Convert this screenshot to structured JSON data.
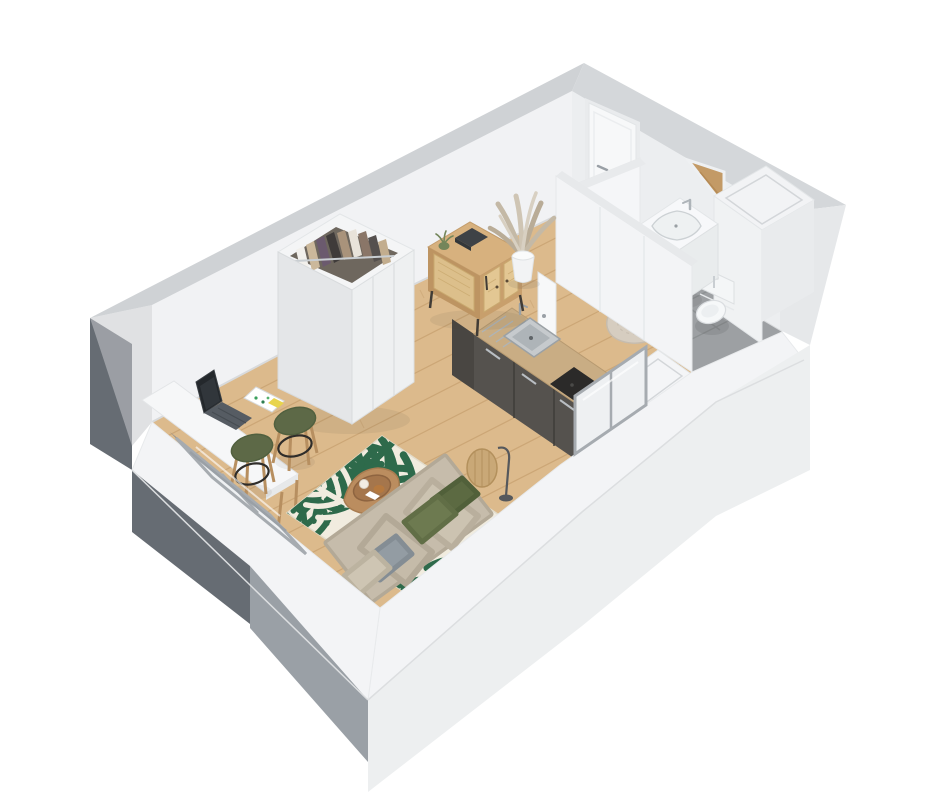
{
  "scene": {
    "description": "Isometric 3D cutaway floor plan render of a studio apartment, viewed from above",
    "background": "#ffffff"
  },
  "palette": {
    "background": "#ffffff",
    "wall_inner": "#f1f2f4",
    "wall_inner_shaded": "#eceef0",
    "wall_top_far": "#cfd2d5",
    "wall_band": "#f3f4f6",
    "exterior_dark": "#666c73",
    "exterior_medium": "#9aa0a6",
    "exterior_pale": "#edeff0",
    "wood_floor": "#dcba8c",
    "wood_line": "#b98f5c",
    "tile_floor": "#9da0a3",
    "tile_line": "#8a8d90",
    "rug_cream": "#f1ecdf",
    "rug_green": "#2e6a4b",
    "sofa_beige": "#c6bcab",
    "pillow_olive": "#6d7a50",
    "pillow_olive_dark": "#5c6a42",
    "pillow_gray": "#939ca3",
    "stool_green": "#5d6947",
    "sideboard_wood": "#d7b17e",
    "rattan_panel": "#e3c793",
    "kitchen_cabinet": "#55524e",
    "kitchen_counter": "#c9ad84",
    "steel": "#a6abb0",
    "door_white": "#f7f8f9",
    "bath_rug": "#d6cdc0",
    "mirror_wood": "#c39a66",
    "lamp_rattan": "#c9a877",
    "plant_beige": "#c4b9a6",
    "plant_green": "#6f8153"
  },
  "apartment": {
    "rooms": [
      {
        "name": "living-area",
        "floor": "light oak wood planks",
        "furniture": [
          "open wardrobe with hanging clothes",
          "rattan sideboard",
          "pampas grass in white pot",
          "wall-mounted white desk",
          "laptop",
          "papers and sticky note",
          "two olive bar stools",
          "palm leaf rug",
          "wood side table with tray",
          "rattan floor lamp",
          "beige sofa bed with olive and grey pillows"
        ]
      },
      {
        "name": "kitchenette",
        "furniture": [
          "dark grey base cabinets",
          "wood countertop",
          "stainless steel sink with drainboard",
          "dark cooktop"
        ]
      },
      {
        "name": "bathroom",
        "floor": "grey tiles",
        "furniture": [
          "white vanity with basin and chrome faucet",
          "triangular mirror",
          "toilet",
          "round beige rug",
          "boxed duct unit"
        ]
      },
      {
        "name": "entry-hall",
        "furniture": [
          "entrance door"
        ]
      }
    ],
    "openings": [
      "entrance door on far wall",
      "bathroom door ajar",
      "french window on lower-left wall with safety rail",
      "window on lower-right wall"
    ]
  }
}
